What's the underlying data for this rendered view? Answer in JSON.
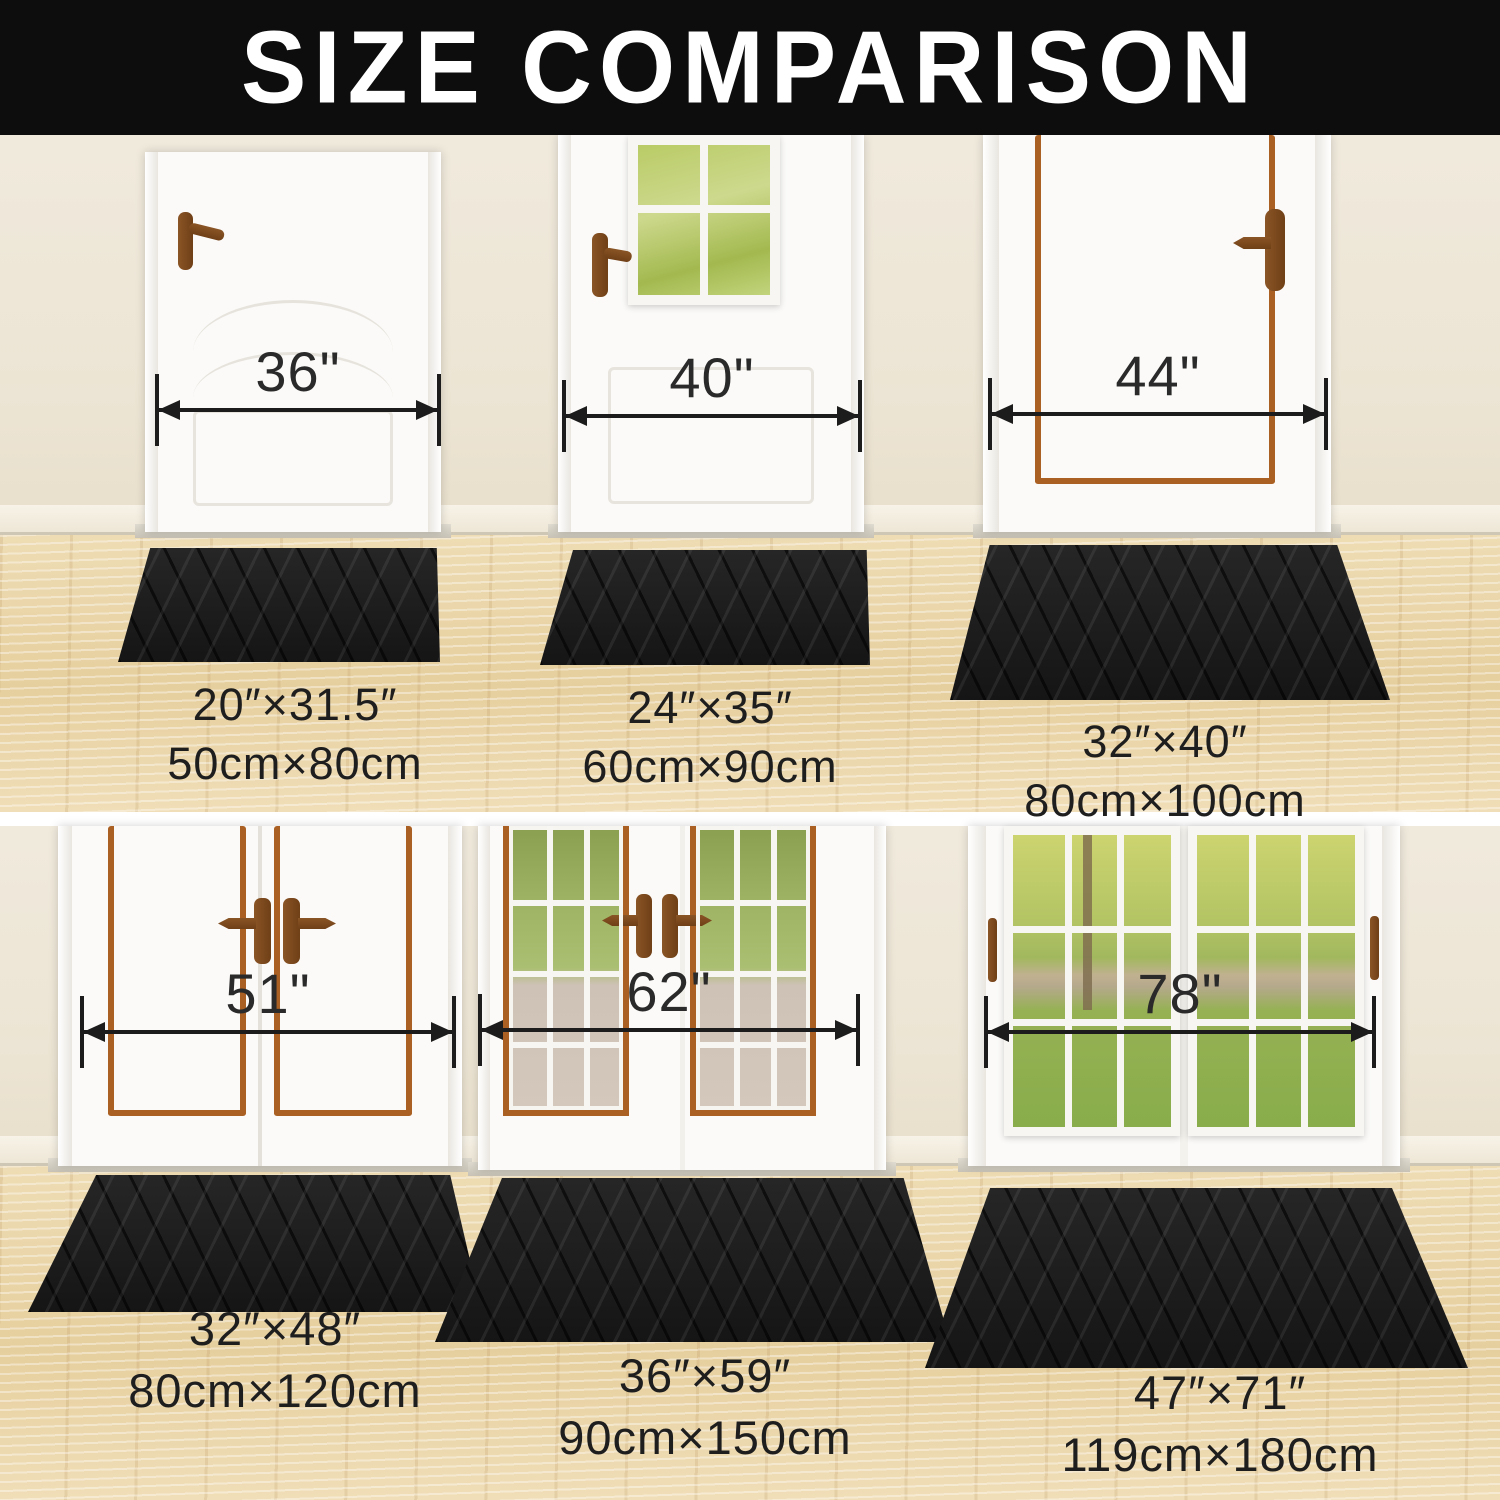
{
  "title": "SIZE COMPARISON",
  "comparisons": [
    {
      "door": "36\"",
      "mat_in": "20″×31.5″",
      "mat_cm": "50cm×80cm"
    },
    {
      "door": "40\"",
      "mat_in": "24″×35″",
      "mat_cm": "60cm×90cm"
    },
    {
      "door": "44\"",
      "mat_in": "32″×40″",
      "mat_cm": "80cm×100cm"
    },
    {
      "door": "51\"",
      "mat_in": "32″×48″",
      "mat_cm": "80cm×120cm"
    },
    {
      "door": "62\"",
      "mat_in": "36″×59″",
      "mat_cm": "90cm×150cm"
    },
    {
      "door": "78\"",
      "mat_in": "47″×71″",
      "mat_cm": "119cm×180cm"
    }
  ],
  "colors": {
    "header_bg": "#0d0d0d",
    "header_text": "#ffffff",
    "wall": "#ece4d3",
    "floor_wood": "#e9d5a8",
    "mat_black": "#1a1a1a",
    "dimension_ink": "#1c1c1c",
    "label_ink": "#1e1e1e",
    "door_white": "#fbfaf8",
    "trim_copper": "#a96022",
    "handle_brown": "#7b4a1e"
  }
}
